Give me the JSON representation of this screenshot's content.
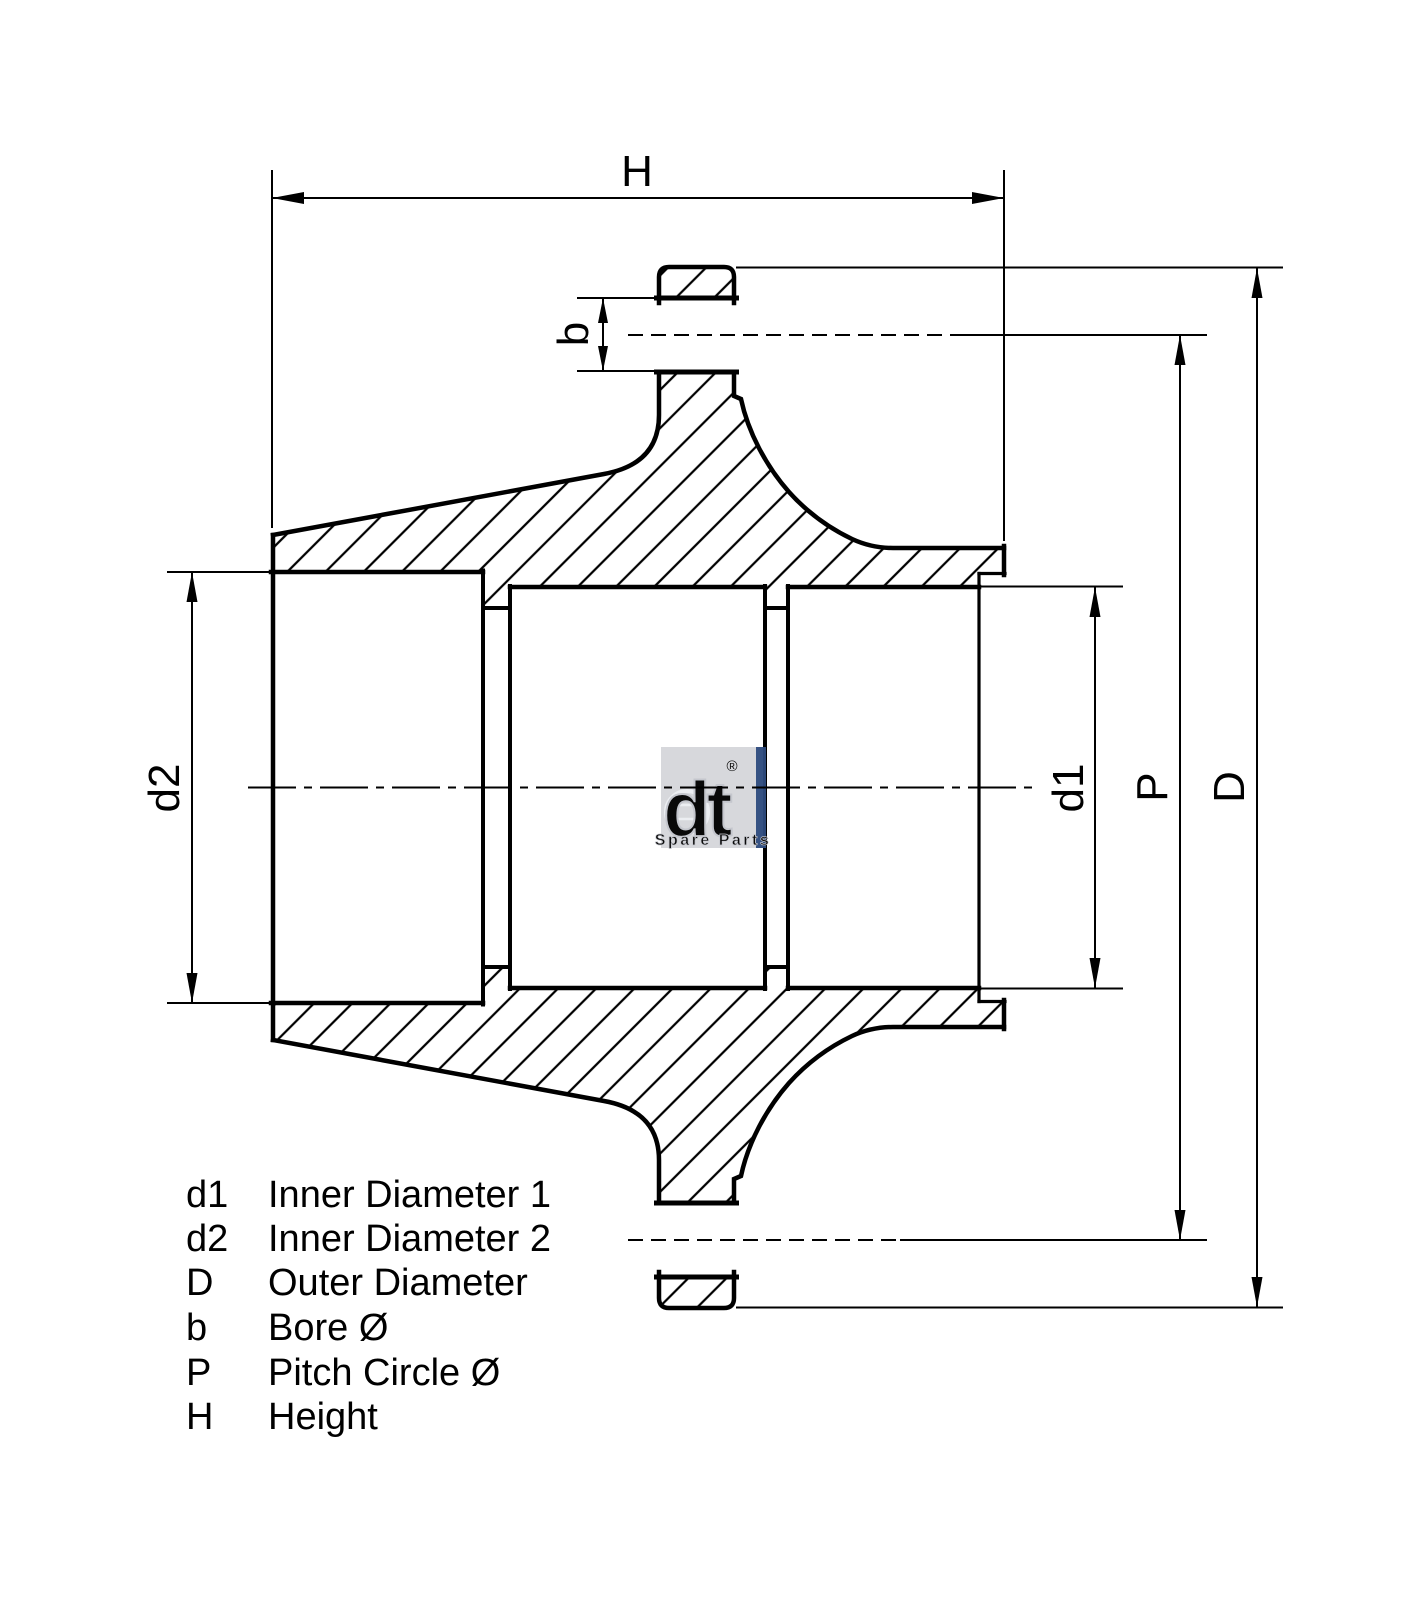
{
  "drawing": {
    "labels": {
      "H": "H",
      "b": "b",
      "d1": "d1",
      "d2": "d2",
      "P": "P",
      "D": "D"
    },
    "legend": {
      "rows": [
        {
          "key": "d1",
          "label": "Inner Diameter 1"
        },
        {
          "key": "d2",
          "label": "Inner Diameter 2"
        },
        {
          "key": "D",
          "label": "Outer Diameter"
        },
        {
          "key": "b",
          "label": "Bore Ø"
        },
        {
          "key": "P",
          "label": "Pitch Circle Ø"
        },
        {
          "key": "H",
          "label": "Height"
        }
      ]
    },
    "watermark": {
      "brand": "dt",
      "registered": "®",
      "tagline": "Spare Parts"
    },
    "colors": {
      "line": "#000000",
      "background": "#ffffff",
      "watermark_gray": "#d6d7db",
      "watermark_blue": "#2e4b7e",
      "watermark_text": "#f2f3f7"
    }
  }
}
